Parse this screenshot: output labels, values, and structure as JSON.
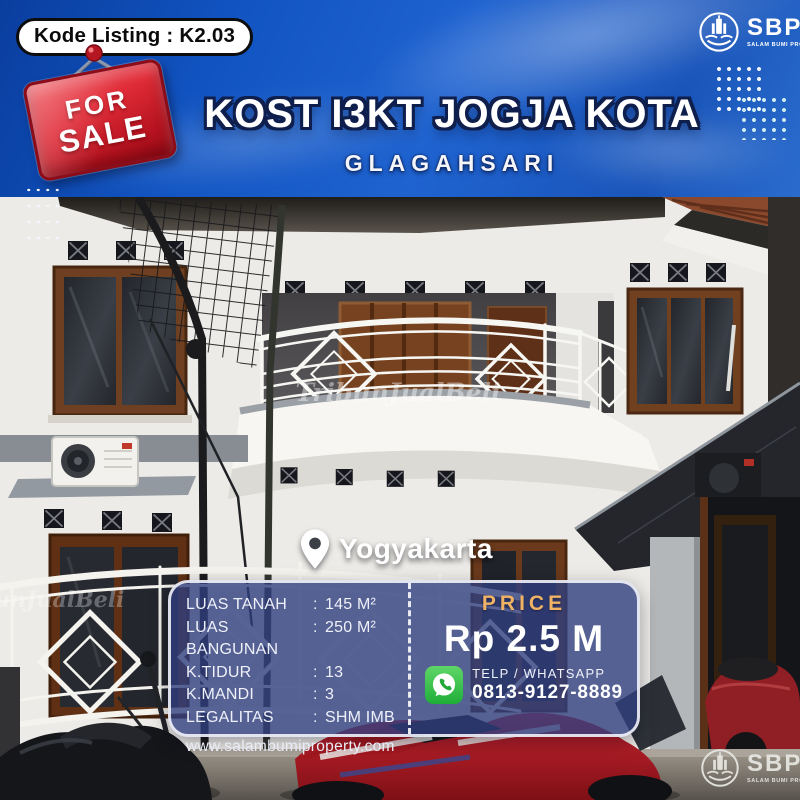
{
  "listing_badge": {
    "text": "Kode Listing : K2.03"
  },
  "sale_sign": {
    "line1": "FOR",
    "line2": "SALE"
  },
  "header": {
    "title": "KOST I3KT JOGJA KOTA",
    "subtitle": "GLAGAHSARI"
  },
  "brand": {
    "name": "SBP",
    "tagline": "SALAM BUMI PROPERTY"
  },
  "photo": {
    "watermark": "TribunJualBeli",
    "location": "Yogyakarta"
  },
  "specs": {
    "separator": ":",
    "rows": [
      {
        "label": "LUAS TANAH",
        "value": "145 M²"
      },
      {
        "label": "LUAS BANGUNAN",
        "value": "250 M²"
      },
      {
        "label": "K.TIDUR",
        "value": "13"
      },
      {
        "label": "K.MANDI",
        "value": "3"
      },
      {
        "label": "LEGALITAS",
        "value": "SHM IMB"
      }
    ],
    "website": "www.salambumiproperty.com"
  },
  "price": {
    "label": "PRICE",
    "value": "Rp 2.5 M"
  },
  "contact": {
    "label": "TELP / WHATSAPP",
    "number": "0813-9127-8889"
  },
  "colors": {
    "sky_blue": "#1154c2",
    "panel_blue": "#2f3e7e",
    "gold": "#f0b264",
    "sign_red": "#d11f2e",
    "whatsapp_green": "#2fc043",
    "title_outline_navy": "#0f1f4d"
  }
}
